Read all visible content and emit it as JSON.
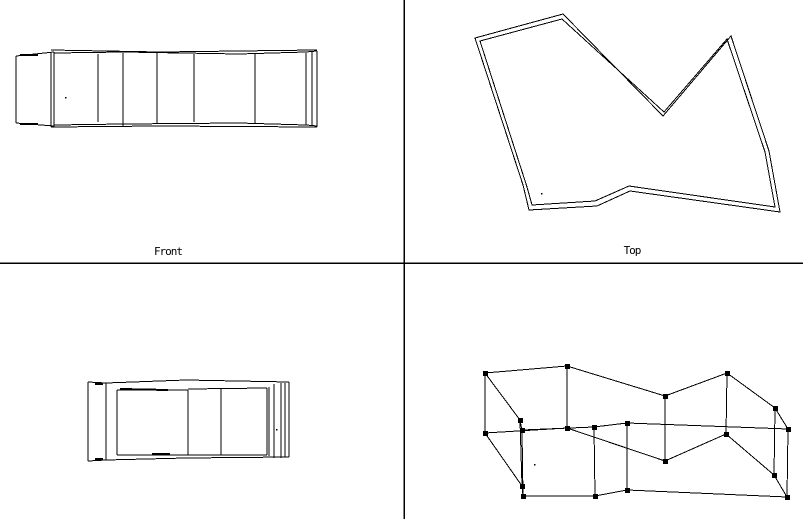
{
  "app": {
    "background_color": "#ffffff",
    "line_color": "#000000",
    "description": "CAD four-viewport wireframe screen"
  },
  "viewports": {
    "front": {
      "label": "Front",
      "label_x": 168,
      "label_y": 246
    },
    "top": {
      "label": "Top",
      "label_x": 632,
      "label_y": 245
    }
  },
  "dividers": {
    "vertical_x": 404,
    "horizontal_y": 263,
    "color": "#000000",
    "width": 1.5
  },
  "drawing": {
    "front_view": {
      "segments": [
        [
          16,
          56,
          16,
          123
        ],
        [
          51,
          52,
          51,
          127
        ],
        [
          54,
          52,
          54,
          127
        ],
        [
          98,
          54,
          98,
          122
        ],
        [
          123,
          53,
          123,
          126
        ],
        [
          157,
          52,
          157,
          124
        ],
        [
          194,
          54,
          194,
          122
        ],
        [
          255,
          54,
          255,
          123
        ],
        [
          306,
          53,
          306,
          125
        ],
        [
          312,
          52,
          312,
          125
        ],
        [
          317,
          51,
          317,
          127
        ],
        [
          16,
          56,
          54,
          52
        ],
        [
          51,
          50,
          160,
          52
        ],
        [
          54,
          53,
          124,
          52
        ],
        [
          124,
          52,
          239,
          54
        ],
        [
          160,
          52,
          317,
          50
        ],
        [
          239,
          54,
          306,
          52
        ],
        [
          306,
          52,
          317,
          51
        ],
        [
          16,
          123,
          54,
          126
        ],
        [
          51,
          127,
          160,
          126
        ],
        [
          54,
          125,
          124,
          124
        ],
        [
          124,
          124,
          239,
          123
        ],
        [
          160,
          126,
          317,
          127
        ],
        [
          239,
          123,
          306,
          125
        ],
        [
          306,
          125,
          317,
          126
        ]
      ],
      "heavy_segments": [
        [
          20,
          55,
          38,
          55
        ],
        [
          20,
          124,
          38,
          124
        ]
      ]
    },
    "top_view": {
      "outer_polygon": [
        [
          475,
          38
        ],
        [
          563,
          14
        ],
        [
          663,
          116
        ],
        [
          731,
          36
        ],
        [
          769,
          151
        ],
        [
          780,
          212
        ],
        [
          630,
          191
        ],
        [
          597,
          206
        ],
        [
          529,
          210
        ],
        [
          523,
          185
        ]
      ],
      "inner_polygon": [
        [
          480,
          41
        ],
        [
          562,
          19
        ],
        [
          664,
          112
        ],
        [
          727,
          39
        ],
        [
          765,
          152
        ],
        [
          775,
          207
        ],
        [
          629,
          186
        ],
        [
          595,
          201
        ],
        [
          532,
          205
        ],
        [
          527,
          187
        ]
      ]
    },
    "side_view": {
      "segments": [
        [
          88,
          382,
          88,
          461
        ],
        [
          106,
          383,
          106,
          460
        ],
        [
          117,
          390,
          117,
          455
        ],
        [
          188,
          390,
          188,
          455
        ],
        [
          221,
          389,
          221,
          455
        ],
        [
          267,
          388,
          267,
          455
        ],
        [
          269,
          387,
          269,
          456
        ],
        [
          274,
          384,
          274,
          458
        ],
        [
          281,
          383,
          281,
          458
        ],
        [
          285,
          383,
          285,
          457
        ],
        [
          289,
          382,
          289,
          457
        ],
        [
          88,
          382,
          106,
          383
        ],
        [
          106,
          383,
          186,
          380
        ],
        [
          186,
          380,
          289,
          382
        ],
        [
          117,
          390,
          188,
          390
        ],
        [
          188,
          389,
          267,
          388
        ],
        [
          88,
          461,
          106,
          460
        ],
        [
          106,
          460,
          186,
          458
        ],
        [
          186,
          458,
          289,
          457
        ],
        [
          117,
          455,
          188,
          455
        ],
        [
          188,
          455,
          267,
          455
        ]
      ],
      "heavy_segments": [
        [
          120,
          389,
          168,
          390
        ],
        [
          95,
          384,
          103,
          384
        ],
        [
          152,
          454,
          170,
          454
        ],
        [
          95,
          459,
          103,
          459
        ]
      ]
    },
    "perspective_view": {
      "top_rail": [
        [
          485,
          373
        ],
        [
          567,
          366
        ],
        [
          665,
          396
        ],
        [
          727,
          373
        ],
        [
          775,
          408
        ],
        [
          788,
          429
        ],
        [
          627,
          423
        ],
        [
          594,
          427
        ],
        [
          522,
          430
        ],
        [
          520,
          420
        ]
      ],
      "bottom_rail": [
        [
          485,
          433
        ],
        [
          567,
          428
        ],
        [
          665,
          461
        ],
        [
          726,
          434
        ],
        [
          774,
          475
        ],
        [
          787,
          497
        ],
        [
          627,
          490
        ],
        [
          595,
          496
        ],
        [
          523,
          496
        ],
        [
          522,
          486
        ]
      ],
      "marker_size": 5
    },
    "stray_dots": [
      [
        65,
        97
      ],
      [
        541,
        193
      ],
      [
        276,
        429
      ],
      [
        534,
        464
      ]
    ]
  }
}
